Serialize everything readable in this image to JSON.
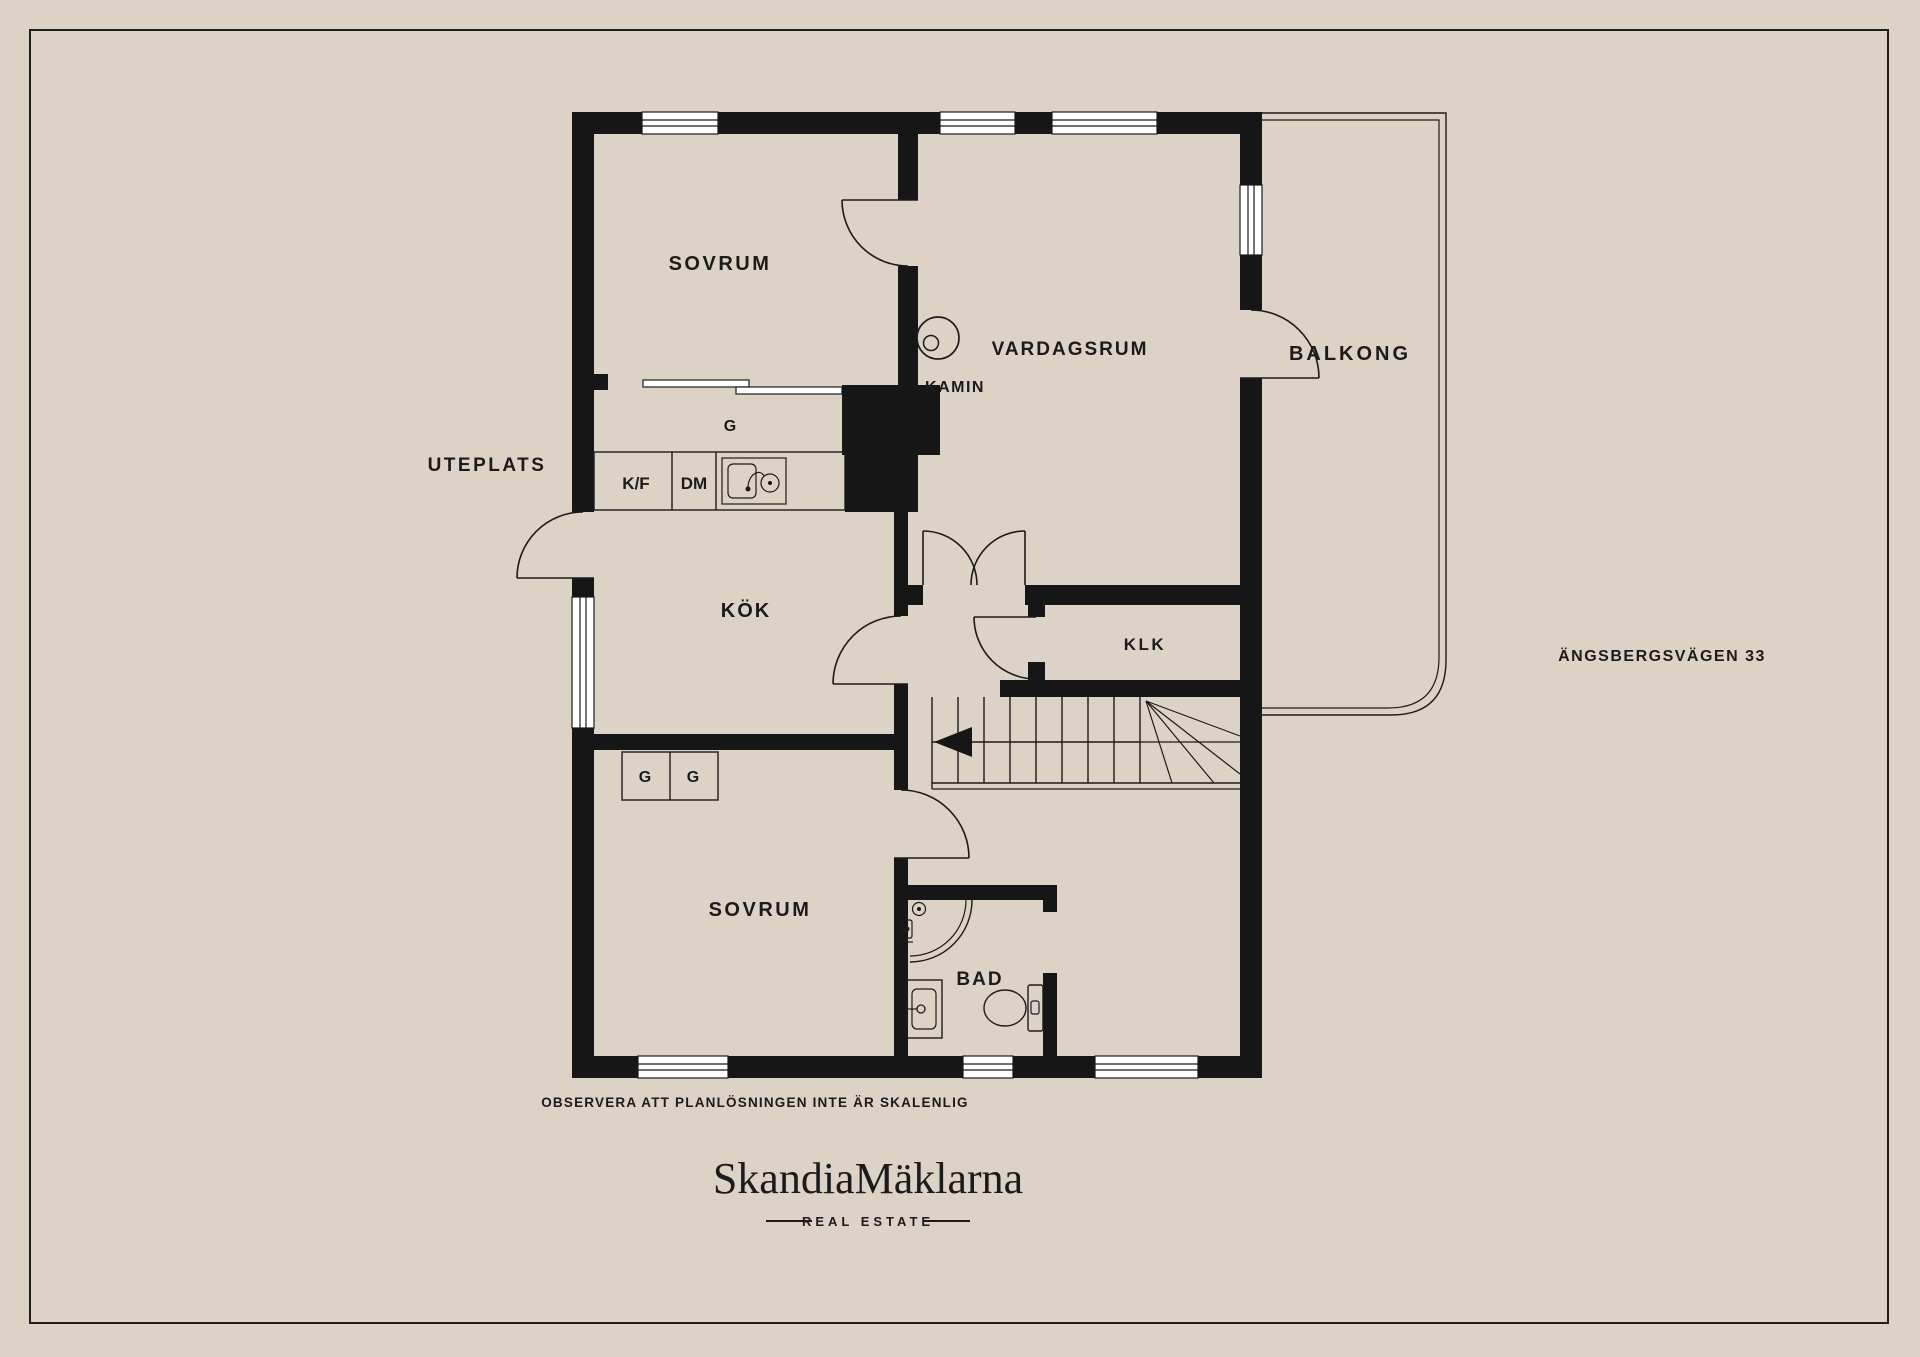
{
  "colors": {
    "background": "#DCD2C6",
    "walls": "#161616",
    "lines": "#1B1B1B",
    "window_glass": "#FFFFFF",
    "text": "#1B1B1B"
  },
  "floorplan": {
    "labels": {
      "bedroom_top": "SOVRUM",
      "living_room": "VARDAGSRUM",
      "fireplace": "KAMIN",
      "balcony": "BALKONG",
      "patio": "UTEPLATS",
      "kitchen": "KÖK",
      "walk_in_closet": "KLK",
      "bedroom_bottom": "SOVRUM",
      "bathroom": "BAD",
      "wardrobe_top": "G",
      "wardrobe_bottom_left": "G",
      "wardrobe_bottom_right": "G",
      "fridge_freezer": "K/F",
      "dishwasher": "DM"
    },
    "address": "ÄNGSBERGSVÄGEN 33",
    "disclaimer": "OBSERVERA ATT PLANLÖSNINGEN INTE ÄR SKALENLIG"
  },
  "footer": {
    "brand": "SkandiaMäklarna",
    "tagline": "REAL ESTATE"
  }
}
